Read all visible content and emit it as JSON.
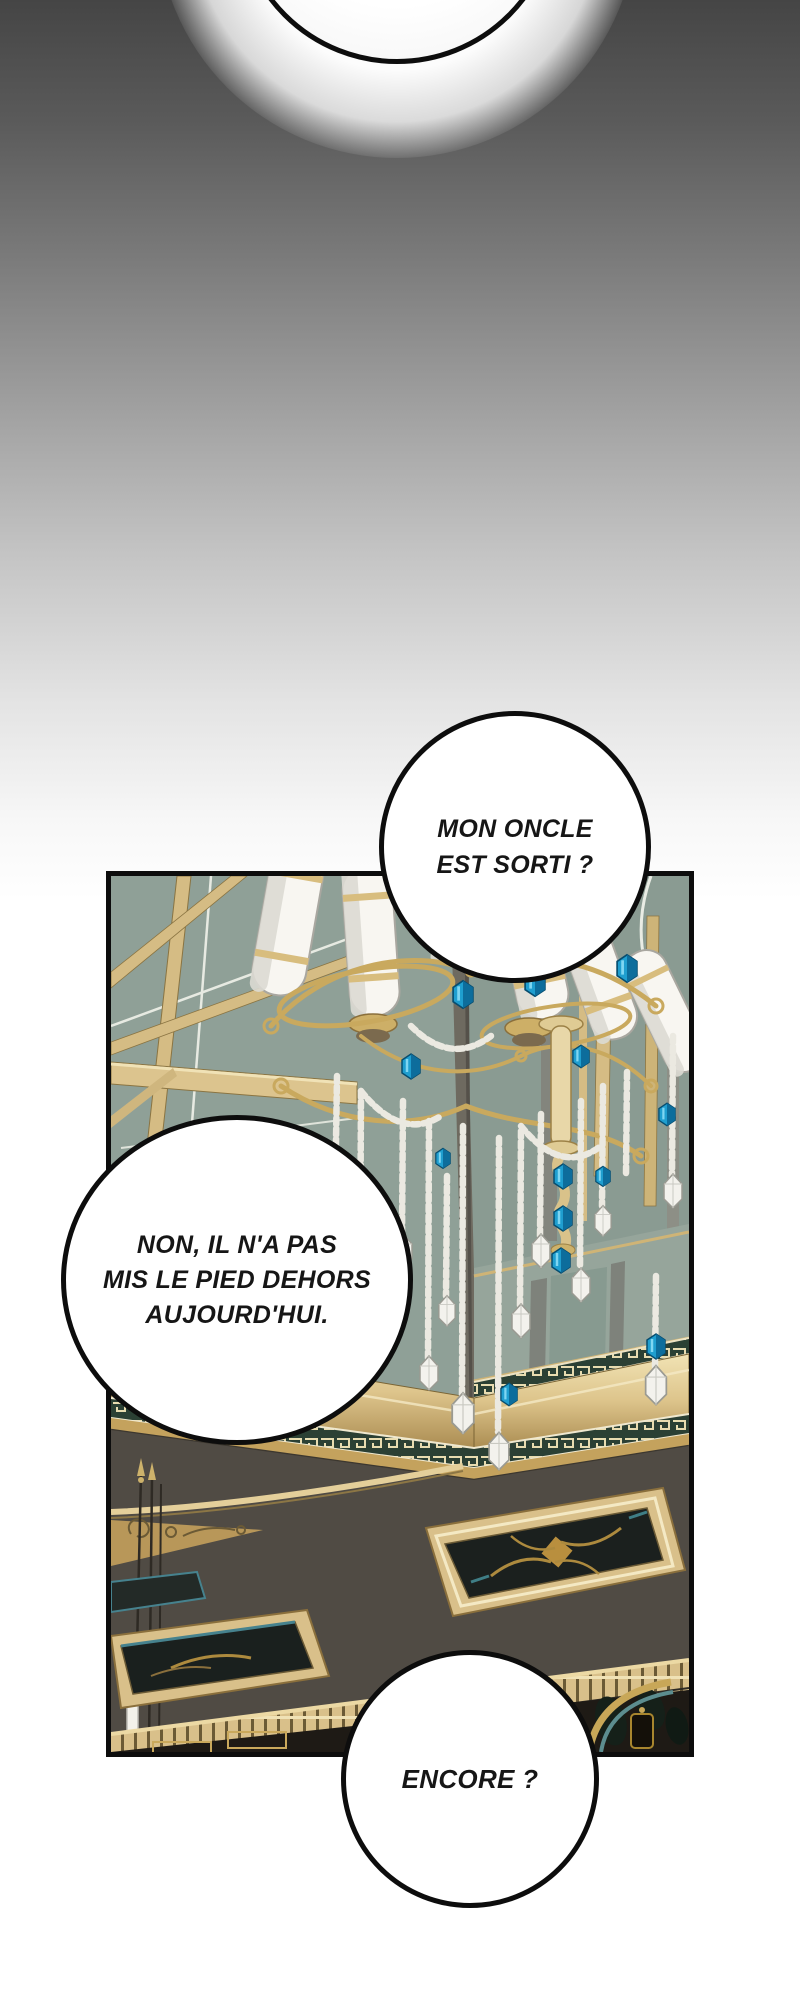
{
  "speech_bubbles": {
    "top_partial": {
      "text": ""
    },
    "uncle": {
      "lines": [
        "MON ONCLE",
        "EST SORTI ?"
      ]
    },
    "reply": {
      "lines": [
        "NON, IL N'A PAS",
        "MIS LE PIED DEHORS",
        "AUJOURD'HUI."
      ]
    },
    "again": {
      "lines": [
        "ENCORE ?"
      ]
    }
  },
  "panel": {
    "description": "Palace hall seen at an angle: sage ceiling with gold beams, gilded chandelier with crystal bead strings and blue gems, gold cornice with Greek-key bands, dark floor with gilded ornamental panels"
  },
  "colors": {
    "bg-top": "#454545",
    "bg-bottom": "#ffffff",
    "bubble-border": "#0d0d0d",
    "bubble-fill": "#ffffff",
    "text": "#161616",
    "panel-border": "#0d0d0d",
    "ceiling": "#8fa097",
    "gold": "#d9c08a",
    "gold-dark": "#8a6f3c",
    "floor": "#504b44",
    "meander-bg": "#2b4034",
    "gem-blue": "#1f9ecf"
  }
}
